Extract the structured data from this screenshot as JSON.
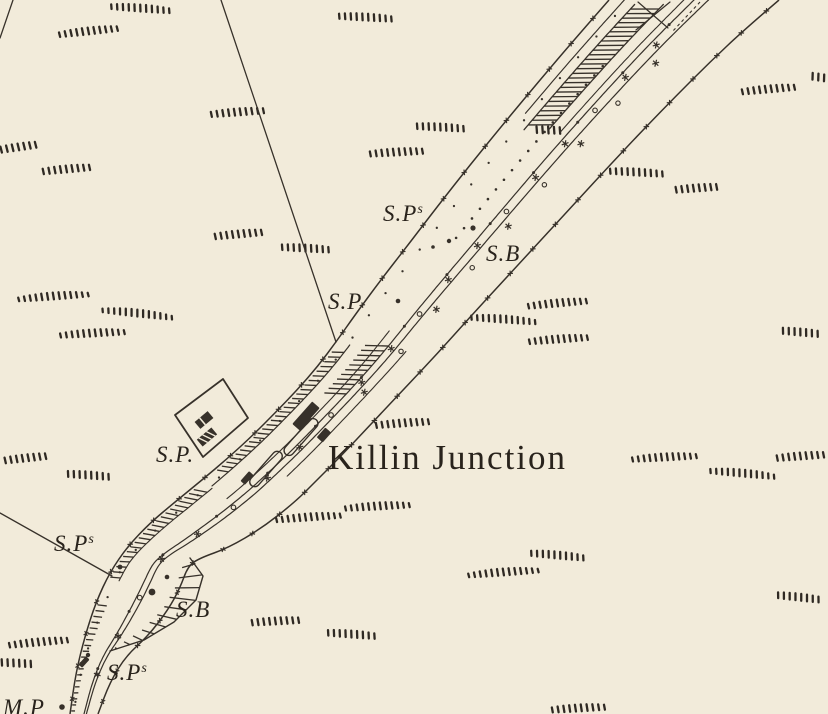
{
  "map": {
    "title": "Killin Junction",
    "annotations": [
      {
        "id": "sps-upper",
        "text": "S.P",
        "sup": "s"
      },
      {
        "id": "sb-upper",
        "text": "S.B",
        "sup": ""
      },
      {
        "id": "sp-mid",
        "text": "S.P",
        "sup": ""
      },
      {
        "id": "sp-station",
        "text": "S.P.",
        "sup": ""
      },
      {
        "id": "sps-left",
        "text": "S.P",
        "sup": "s"
      },
      {
        "id": "sb-lower",
        "text": "S.B",
        "sup": ""
      },
      {
        "id": "sps-bottom",
        "text": "S.P",
        "sup": "s"
      },
      {
        "id": "mp-bottom",
        "text": "M.P",
        "sup": ""
      }
    ],
    "colors": {
      "paper": "#f2ebda",
      "ink": "#37312a",
      "label_ink": "#29231c"
    }
  }
}
